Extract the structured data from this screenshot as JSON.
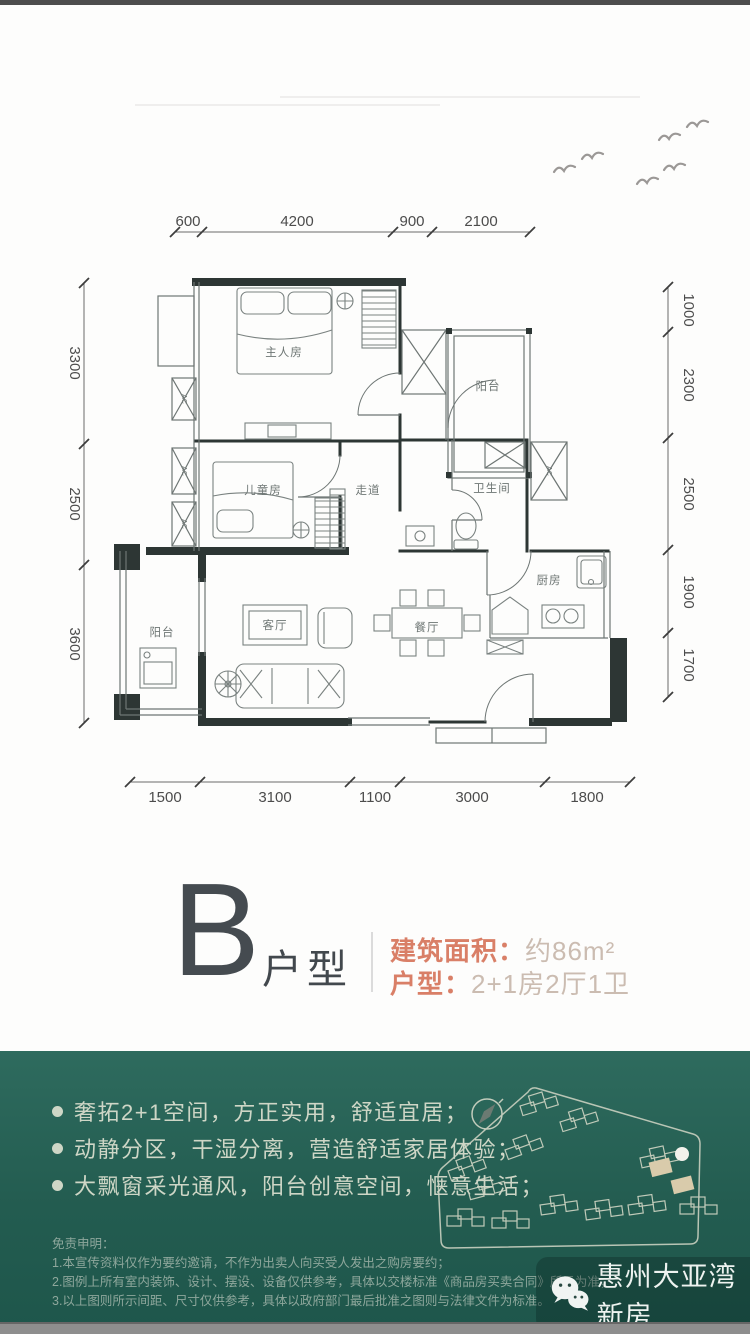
{
  "plan": {
    "rooms": {
      "master": "主人房",
      "kids": "儿童房",
      "corridor": "走道",
      "bath": "卫生间",
      "balcony_top": "阳台",
      "balcony_left": "阳台",
      "living": "客厅",
      "dining": "餐厅",
      "kitchen": "厨房",
      "ac": "AC"
    },
    "dims": {
      "top": [
        "600",
        "4200",
        "900",
        "2100"
      ],
      "left": [
        "3300",
        "2500",
        "3600"
      ],
      "right": [
        "1000",
        "2300",
        "2500",
        "1900",
        "1700"
      ],
      "bottom": [
        "1500",
        "3100",
        "1100",
        "3000",
        "1800"
      ]
    }
  },
  "unit": {
    "letter": "B",
    "suffix": "户型",
    "area_label": "建筑面积：",
    "area_value": "约86m²",
    "layout_label": "户型：",
    "layout_value": "2+1房2厅1卫"
  },
  "features": [
    "奢拓2+1空间，方正实用，舒适宜居；",
    "动静分区，干湿分离，营造舒适家居体验；",
    "大飘窗采光通风，阳台创意空间，惬意生活；"
  ],
  "disclaimer": {
    "title": "免责申明：",
    "lines": [
      "1.本宣传资料仅作为要约邀请，不作为出卖人向买受人发出之购房要约；",
      "2.图例上所有室内装饰、设计、摆设、设备仅供参考，具体以交楼标准《商品房买卖合同》所示为准；",
      "3.以上图则所示间距、尺寸仅供参考，具体以政府部门最后批准之图则与法律文件为标准。"
    ]
  },
  "watermark": {
    "name": "惠州大亚湾新房"
  },
  "colors": {
    "accent": "#D97F67",
    "green": "#235C50",
    "wall": "#2D3634"
  }
}
